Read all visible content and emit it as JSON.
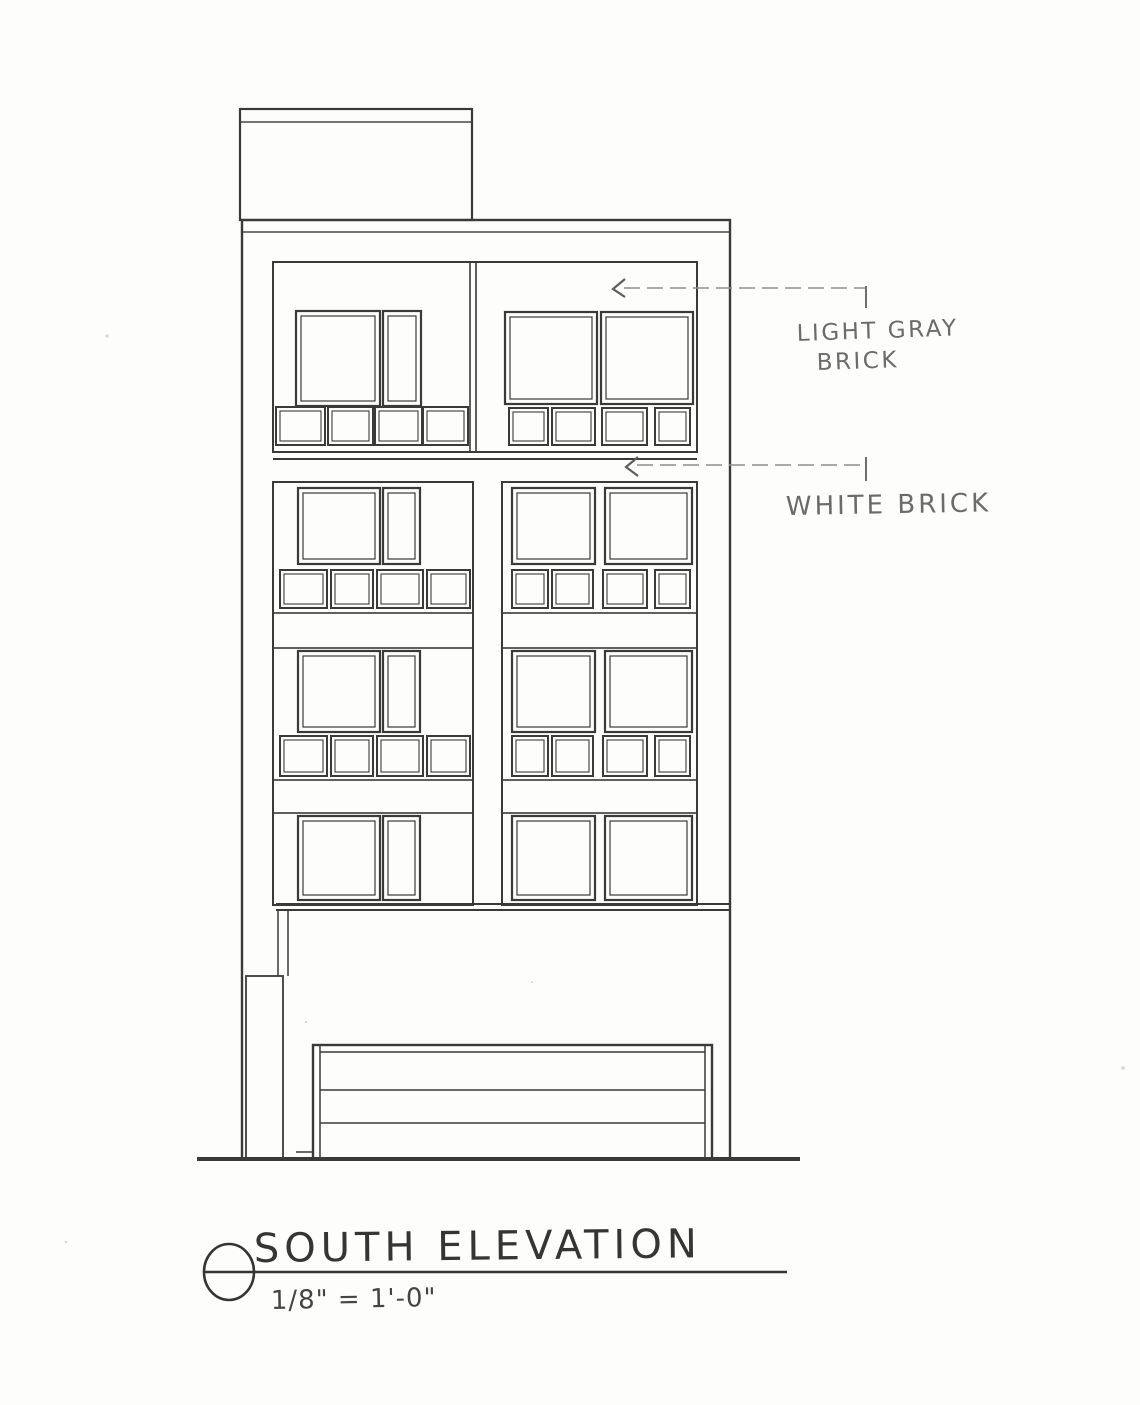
{
  "annotations": {
    "light_gray_brick": {
      "line1": "LIGHT GRAY",
      "line2": "BRICK"
    },
    "white_brick": "WHITE BRICK"
  },
  "title_block": {
    "title": "SOUTH ELEVATION",
    "scale": "1/8\" = 1'-0\""
  },
  "colors": {
    "paper": "#fdfdfb",
    "ink": "#3a3a3a",
    "pencil": "#6b6b6b",
    "hatch_light_gray_brick": "#9b9b9b",
    "hatch_white_brick": "#ababab"
  }
}
